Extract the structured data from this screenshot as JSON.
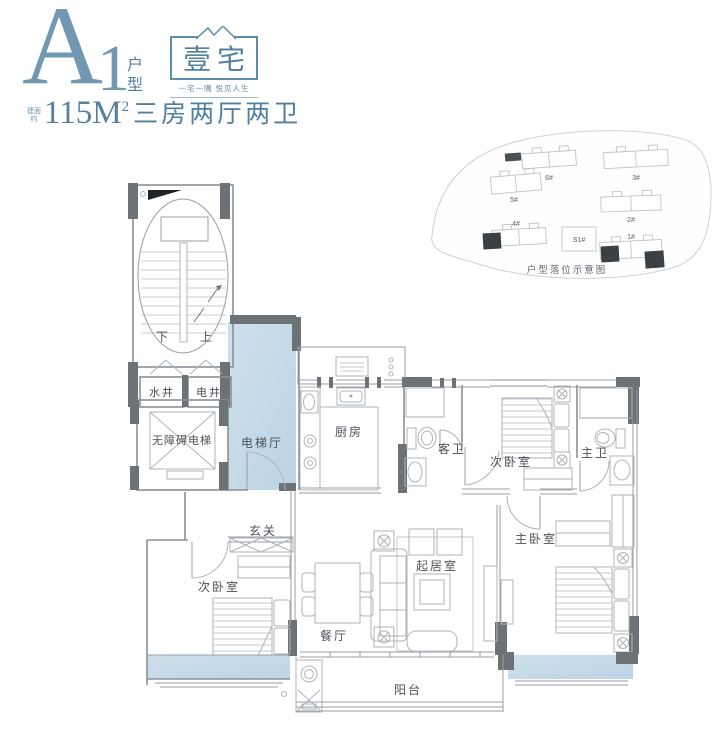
{
  "header": {
    "unit_code_letter": "A",
    "unit_code_number": "1",
    "unit_type_label": "户型",
    "area_prefix_line1": "建面",
    "area_prefix_line2": "约",
    "area_value": "115M",
    "area_superscript": "2",
    "layout_description": "三房两厅两卫",
    "logo": {
      "char1": "壹",
      "char2": "宅",
      "tagline": "一宅一隅  悦见人生"
    }
  },
  "site_map": {
    "caption": "户型落位示意图",
    "buildings": {
      "b6": {
        "label": "6#"
      },
      "b5": {
        "label": "5#"
      },
      "b4": {
        "label": "4#"
      },
      "b3": {
        "label": "3#"
      },
      "b2": {
        "label": "2#"
      },
      "b1": {
        "label": "1#"
      },
      "s1": {
        "label": "S1#"
      }
    }
  },
  "floor_plan": {
    "rooms": {
      "stairs_down": {
        "label": "下"
      },
      "stairs_up": {
        "label": "上"
      },
      "water_shaft": {
        "label": "水井"
      },
      "electric_shaft": {
        "label": "电井"
      },
      "elevator": {
        "label": "无障碍电梯"
      },
      "elevator_hall": {
        "label": "电梯厅"
      },
      "kitchen": {
        "label": "厨房"
      },
      "guest_bathroom": {
        "label": "客卫"
      },
      "bedroom_top": {
        "label": "次卧室"
      },
      "master_bathroom": {
        "label": "主卫"
      },
      "foyer": {
        "label": "玄关"
      },
      "bedroom_left": {
        "label": "次卧室"
      },
      "dining_room": {
        "label": "餐厅"
      },
      "living_room": {
        "label": "起居室"
      },
      "master_bedroom": {
        "label": "主卧室"
      },
      "balcony": {
        "label": "阳台"
      }
    }
  },
  "colors": {
    "accent_blue": "#7297b3",
    "room_highlight_blue": "#c7dbe9",
    "wall_dark": "#6d7277"
  }
}
